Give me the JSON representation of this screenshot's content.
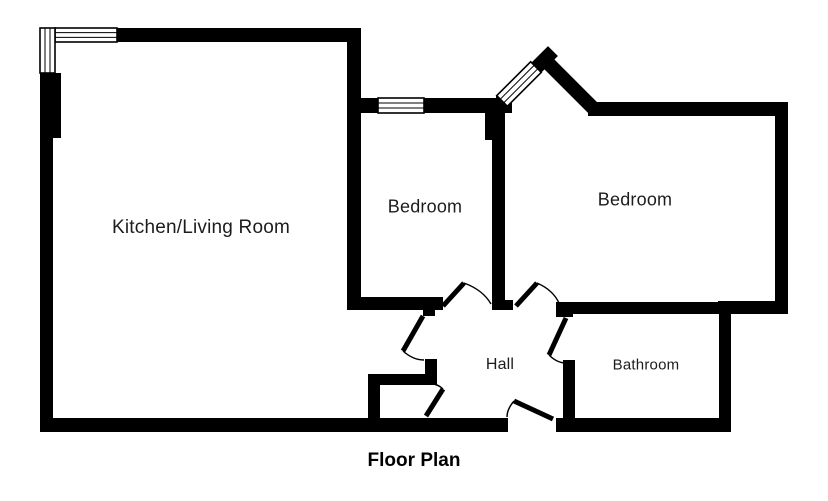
{
  "title": {
    "label": "Floor Plan",
    "x": 414,
    "y": 461,
    "size": 19
  },
  "colors": {
    "wall": "#000000",
    "background": "#ffffff",
    "label_text": "#1c1c1c",
    "door_line": "#000000"
  },
  "rooms": [
    {
      "id": "kitchen-living-room",
      "label": "Kitchen/Living Room",
      "x": 201,
      "y": 228,
      "size": 19
    },
    {
      "id": "bedroom-1",
      "label": "Bedroom",
      "x": 425,
      "y": 207,
      "size": 18
    },
    {
      "id": "bedroom-2",
      "label": "Bedroom",
      "x": 635,
      "y": 200,
      "size": 18
    },
    {
      "id": "hall",
      "label": "Hall",
      "x": 500,
      "y": 365,
      "size": 16
    },
    {
      "id": "bathroom",
      "label": "Bathroom",
      "x": 646,
      "y": 365,
      "size": 15
    }
  ],
  "floorplan": {
    "walls": [
      [
        116,
        28,
        245,
        14
      ],
      [
        40,
        73,
        21,
        65
      ],
      [
        40,
        73,
        13,
        345
      ],
      [
        40,
        418,
        468,
        14
      ],
      [
        556,
        418,
        175,
        14
      ],
      [
        347,
        42,
        14,
        268
      ],
      [
        352,
        98,
        26,
        15
      ],
      [
        424,
        98,
        79,
        15
      ],
      [
        492,
        112,
        13,
        198
      ],
      [
        485,
        112,
        7,
        28
      ],
      [
        347,
        297,
        96,
        13
      ],
      [
        492,
        300,
        21,
        10
      ],
      [
        588,
        102,
        200,
        14
      ],
      [
        775,
        102,
        13,
        212
      ],
      [
        718,
        301,
        70,
        13
      ],
      [
        719,
        301,
        12,
        131
      ],
      [
        556,
        302,
        164,
        12
      ],
      [
        556,
        302,
        17,
        15
      ],
      [
        563,
        360,
        12,
        58
      ],
      [
        423,
        310,
        12,
        6
      ],
      [
        368,
        374,
        69,
        11
      ],
      [
        368,
        385,
        12,
        33
      ],
      [
        425,
        359,
        12,
        26
      ],
      [
        496,
        96,
        16,
        17
      ]
    ],
    "diagonal_walls": [
      {
        "x1": 545,
        "y1": 60,
        "x2": 591,
        "y2": 106,
        "width": 14
      },
      {
        "x1": 534,
        "y1": 70,
        "x2": 548,
        "y2": 56,
        "width": 14
      }
    ],
    "windows": [
      {
        "id": "corner-window-top",
        "x": 55,
        "y": 28,
        "w": 62,
        "h": 14,
        "angle": 0,
        "lines": "horizontal"
      },
      {
        "id": "corner-window-left",
        "x": 40,
        "y": 28,
        "w": 15,
        "h": 45,
        "angle": 0,
        "lines": "vertical"
      },
      {
        "id": "bedroom1-window",
        "x": 378,
        "y": 98,
        "w": 46,
        "h": 15,
        "angle": 0,
        "lines": "horizontal"
      },
      {
        "id": "bay-window-diagonal",
        "cx": 519,
        "cy": 84,
        "w": 48,
        "h": 15,
        "angle": -45,
        "lines": "horizontal"
      }
    ],
    "doors": [
      {
        "id": "bedroom1-door",
        "leaf": [
          443,
          306,
          464,
          283
        ],
        "arc": "M 464 283 Q 483 290 491 304"
      },
      {
        "id": "bedroom2-door",
        "leaf": [
          516,
          306,
          537,
          283
        ],
        "arc": "M 537 283 Q 553 290 559 303"
      },
      {
        "id": "bathroom-door",
        "leaf": [
          566,
          318,
          549,
          355
        ],
        "arc": "M 549 355 Q 557 363 566 363"
      },
      {
        "id": "entrance-door",
        "leaf": [
          553,
          419,
          514,
          401
        ],
        "arc": "M 514 401 Q 507 409 507 417"
      },
      {
        "id": "hall-door",
        "leaf": [
          423,
          316,
          403,
          351
        ],
        "arc": "M 403 351 Q 413 360 424 360"
      },
      {
        "id": "storage-door",
        "leaf": [
          443,
          389,
          426,
          416
        ],
        "arc": "M 431 384 Q 438 384 443 389"
      }
    ]
  }
}
